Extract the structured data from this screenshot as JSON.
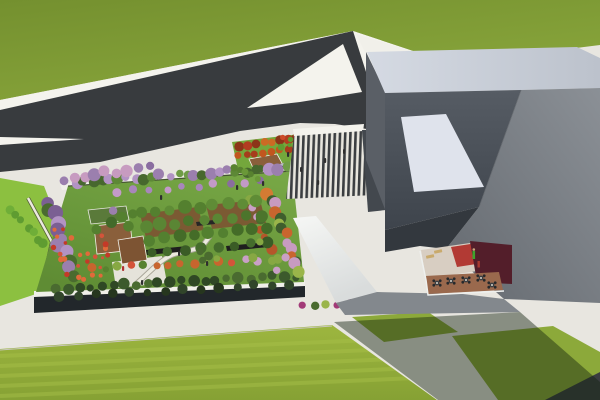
{
  "scene": {
    "title": "Aerial 3D architectural rendering",
    "description": "Bird's-eye render of a low building whose roof is a landscaped garden park, next to a large angular gray building with a striped entry plaza, a forked dark asphalt road through green fields, lawns, flowering trees and a small cafe terrace",
    "view": "aerial-perspective",
    "regions": [
      {
        "name": "grass-field",
        "detail": "large olive-green meadow, upper left"
      },
      {
        "name": "asphalt-road",
        "detail": "dark road forking into a hairpin with white median gores"
      },
      {
        "name": "rooftop-garden",
        "detail": "roof park with lawn, orchard rows, winding path, pavilion decks, flowering trees"
      },
      {
        "name": "striped-plaza",
        "detail": "zebra-striped paved forecourt between garden and gray building"
      },
      {
        "name": "gray-building",
        "detail": "folded-plate gray building with light roof band and white skylight"
      },
      {
        "name": "cafe-terrace",
        "detail": "small courtyard with red / maroon floor, benches and round tables"
      },
      {
        "name": "mown-lawn",
        "detail": "striped lawn along the bottom with building shadow"
      }
    ]
  },
  "colors": {
    "pavement": "#E8E6E0",
    "pavement_bright": "#F4F3ED",
    "grass_dark": "#74902F",
    "grass_light": "#8AA73C",
    "road": "#383B3E",
    "stripe_dark": "#3B3E41",
    "stripe_light": "#E8E6DE",
    "left_strip_green": "#8CC040",
    "park_lawn": "#74A73C",
    "glawn_hi": "#77A745",
    "glawn_lo": "#5F8C34",
    "lawn_hi": "#9DB63F",
    "lawn_lo": "#86A134",
    "mow_stripe": "#A8C14A",
    "soil": "#7B5A33",
    "deck_brown": "#8A5F3B",
    "deck_brown2": "#7D5433",
    "pavilion_roof": "#5A7A3A",
    "plaza_white": "#E5E3DA",
    "seat_bar": "#1E1E1E",
    "path": "#ECEADF",
    "path_casing": "#A8A598",
    "parapet": "#F0EFE9",
    "glass": "#22272B",
    "roof_hi": "#D5DAE3",
    "roof_lo": "#BCC2CC",
    "left_face": "#5A5F66",
    "dark_hi": "#565C64",
    "dark_lo": "#3E444C",
    "mid_hi": "#8B9096",
    "mid_lo": "#64696F",
    "notch": "#33383E",
    "plaza_side_wall": "#43484E",
    "skylight": "#DFE3EC",
    "wing_hi": "#F6F7F5",
    "wing_lo": "#D9DCDC",
    "wall_band": "#83888D",
    "terrace_beige": "#D8CEC2",
    "terrace_red": "#B23A34",
    "terrace_maroon": "#531E2A",
    "terrace_brown": "#9A694D",
    "bench": "#C9AA6C",
    "person_green": "#3FA32C",
    "person_red": "#A83A30",
    "shadow": "#14230F",
    "hedge_line": "#39402E",
    "kiosk": "#26292C",
    "kiosk_top": "#B9BEC4",
    "corner_road": "#3A3D40",
    "table_top": "#3A3E42",
    "chair": "#26292C",
    "table_dot": "#D8D5CC",
    "skin": "#CAA57A",
    "person_default": "#2E2E2E"
  },
  "vegetation": {
    "clusters": [
      {
        "name": "garden-top-row",
        "kind": "row",
        "p": [
          76,
          182,
          288,
          168
        ],
        "n": 26,
        "r": [
          3.5,
          6.5
        ],
        "jitter": 5,
        "colors": [
          "#47682E",
          "#5D8836",
          "#6F9C46",
          "#9B7FAE",
          "#B293C4"
        ]
      },
      {
        "name": "garden-topleft-purple",
        "kind": "row",
        "p": [
          62,
          180,
          150,
          166
        ],
        "n": 9,
        "r": [
          4,
          7
        ],
        "jitter": 5,
        "colors": [
          "#9B7FAE",
          "#8A6DA0",
          "#C79BC0"
        ]
      },
      {
        "name": "garden-left-col",
        "kind": "row",
        "p": [
          48,
          202,
          72,
          276
        ],
        "n": 12,
        "r": [
          5,
          8
        ],
        "jitter": 8,
        "colors": [
          "#9B7FAE",
          "#7B5F93",
          "#4A6B2F",
          "#B293C4"
        ]
      },
      {
        "name": "garden-bottom-row",
        "kind": "row",
        "p": [
          56,
          288,
          296,
          276
        ],
        "n": 22,
        "r": [
          3.5,
          6
        ],
        "jitter": 4,
        "colors": [
          "#3C5A2C",
          "#2F4824",
          "#4A6B30"
        ]
      },
      {
        "name": "garden-right-col",
        "kind": "row",
        "p": [
          270,
          192,
          298,
          272
        ],
        "n": 14,
        "r": [
          4,
          6.5
        ],
        "jitter": 7,
        "colors": [
          "#C8652E",
          "#9AB54A",
          "#C79BC0",
          "#3F5E2D",
          "#D47B33"
        ]
      },
      {
        "name": "garden-right-col2",
        "kind": "row",
        "p": [
          252,
          198,
          278,
          268
        ],
        "n": 10,
        "r": [
          3.5,
          5.5
        ],
        "jitter": 7,
        "colors": [
          "#B5562A",
          "#87A843",
          "#C9A0C6",
          "#4A6B2F"
        ]
      },
      {
        "name": "orchard-row1",
        "kind": "row",
        "p": [
          142,
          212,
          256,
          202
        ],
        "n": 9,
        "r": [
          5,
          7
        ],
        "jitter": 3,
        "colors": [
          "#54802F",
          "#5F8C36"
        ]
      },
      {
        "name": "orchard-row2",
        "kind": "row",
        "p": [
          146,
          226,
          262,
          215
        ],
        "n": 9,
        "r": [
          5,
          7
        ],
        "jitter": 3,
        "colors": [
          "#4C752C",
          "#5A8634"
        ]
      },
      {
        "name": "orchard-row3",
        "kind": "row",
        "p": [
          150,
          240,
          266,
          228
        ],
        "n": 9,
        "r": [
          5,
          6.5
        ],
        "jitter": 3,
        "colors": [
          "#446C28",
          "#538030"
        ]
      },
      {
        "name": "orchard-row4",
        "kind": "row",
        "p": [
          152,
          254,
          268,
          242
        ],
        "n": 8,
        "r": [
          4.5,
          6
        ],
        "jitter": 3,
        "colors": [
          "#3A5C26",
          "#456C2C"
        ]
      },
      {
        "name": "garden-mid-purple",
        "kind": "row",
        "p": [
          118,
          192,
          262,
          182
        ],
        "n": 10,
        "r": [
          3,
          4.5
        ],
        "jitter": 4,
        "colors": [
          "#A886BB",
          "#C39AC8",
          "#8A6DA0"
        ]
      },
      {
        "name": "garden-inner-shrubs",
        "kind": "row",
        "p": [
          92,
          268,
          284,
          258
        ],
        "n": 16,
        "r": [
          3,
          5
        ],
        "jitter": 5,
        "colors": [
          "#C8652E",
          "#87A843",
          "#C9A0C6",
          "#58822F",
          "#D4543A"
        ]
      },
      {
        "name": "coral-swath",
        "kind": "blob",
        "p": [
          52,
          228,
          56,
          52
        ],
        "n": 26,
        "r": [
          1.5,
          3
        ],
        "jitter": 0,
        "colors": [
          "#D4543A",
          "#C43A28",
          "#E06A3A"
        ]
      },
      {
        "name": "left-strip-hedges",
        "kind": "row",
        "p": [
          12,
          210,
          44,
          244
        ],
        "n": 7,
        "r": [
          3.5,
          5.5
        ],
        "jitter": 5,
        "colors": [
          "#5F9C31",
          "#6FAE38"
        ]
      },
      {
        "name": "park-tree-row1",
        "kind": "row",
        "p": [
          240,
          146,
          296,
          138
        ],
        "n": 8,
        "r": [
          3.5,
          5
        ],
        "jitter": 2,
        "colors": [
          "#B23C20",
          "#CC6A24",
          "#8C3418"
        ]
      },
      {
        "name": "park-tree-row2",
        "kind": "row",
        "p": [
          238,
          156,
          288,
          149
        ],
        "n": 7,
        "r": [
          3,
          4.5
        ],
        "jitter": 2,
        "colors": [
          "#C2561E",
          "#A63D1C"
        ]
      },
      {
        "name": "park-green-hedge",
        "kind": "row",
        "p": [
          234,
          168,
          258,
          178
        ],
        "n": 5,
        "r": [
          3,
          4
        ],
        "jitter": 3,
        "colors": [
          "#58822F",
          "#6A9838"
        ]
      },
      {
        "name": "plaza-flowers",
        "kind": "row",
        "p": [
          298,
          190,
          364,
          186
        ],
        "n": 9,
        "r": [
          1.8,
          3
        ],
        "jitter": 3,
        "colors": [
          "#C75B9B",
          "#A23A78",
          "#D981B5"
        ]
      },
      {
        "name": "plaza-left-hedge",
        "kind": "blob",
        "p": [
          280,
          134,
          18,
          16
        ],
        "n": 5,
        "r": [
          2,
          3.5
        ],
        "jitter": 0,
        "colors": [
          "#4A7A2C",
          "#CC4A28",
          "#5F9C31"
        ]
      },
      {
        "name": "plaza-right-hedge",
        "kind": "blob",
        "p": [
          364,
          131,
          30,
          18
        ],
        "n": 7,
        "r": [
          2,
          3.5
        ],
        "jitter": 0,
        "colors": [
          "#4A7A2C",
          "#CC4A28",
          "#5F9C31"
        ]
      },
      {
        "name": "building-strip-shrubs",
        "kind": "row",
        "p": [
          302,
          305,
          458,
          300
        ],
        "n": 14,
        "r": [
          2.5,
          4.5
        ],
        "jitter": 3,
        "colors": [
          "#A23A78",
          "#8C2F66",
          "#4A6B2F",
          "#9AB54A"
        ]
      },
      {
        "name": "building-right-shrubs",
        "kind": "row",
        "p": [
          542,
          289,
          578,
          298
        ],
        "n": 5,
        "r": [
          2.5,
          4
        ],
        "jitter": 3,
        "colors": [
          "#B5479B",
          "#A23A78"
        ]
      },
      {
        "name": "facade-trees",
        "kind": "row",
        "p": [
          60,
          296,
          290,
          284
        ],
        "n": 14,
        "r": [
          3.5,
          5.5
        ],
        "jitter": 3,
        "colors": [
          "#26361E",
          "#31452A"
        ]
      },
      {
        "name": "garden-center-accent",
        "kind": "blob",
        "p": [
          200,
          240,
          60,
          22
        ],
        "n": 6,
        "r": [
          3,
          4.5
        ],
        "jitter": 0,
        "colors": [
          "#4A6B2F",
          "#87A843"
        ]
      },
      {
        "name": "pavilion-trees",
        "kind": "blob",
        "p": [
          92,
          206,
          44,
          26
        ],
        "n": 6,
        "r": [
          4,
          6
        ],
        "jitter": 0,
        "colors": [
          "#54802F",
          "#9B7FAE",
          "#436A2A"
        ]
      }
    ]
  },
  "people": [
    {
      "x": 160,
      "y": 195
    },
    {
      "x": 178,
      "y": 251
    },
    {
      "x": 206,
      "y": 261
    },
    {
      "x": 141,
      "y": 280
    },
    {
      "x": 236,
      "y": 185
    },
    {
      "x": 300,
      "y": 167
    },
    {
      "x": 324,
      "y": 158
    },
    {
      "x": 343,
      "y": 149
    },
    {
      "x": 317,
      "y": 180
    },
    {
      "x": 262,
      "y": 181
    },
    {
      "x": 287,
      "y": 152
    },
    {
      "x": 122,
      "y": 266,
      "c": "#B03030"
    }
  ],
  "terrace": {
    "tables": [
      {
        "x": 437,
        "y": 283
      },
      {
        "x": 451,
        "y": 281
      },
      {
        "x": 466,
        "y": 280
      },
      {
        "x": 481,
        "y": 278
      },
      {
        "x": 492,
        "y": 285
      }
    ]
  }
}
